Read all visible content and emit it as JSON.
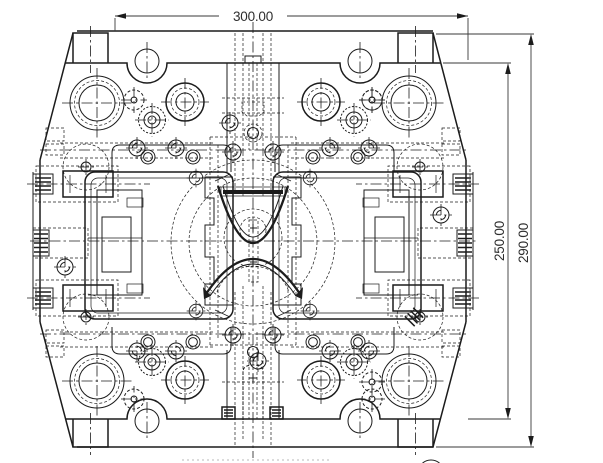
{
  "dimensions": {
    "width_label": "300.00",
    "plate_height_label": "250.00",
    "overall_height_label": "290.00"
  }
}
